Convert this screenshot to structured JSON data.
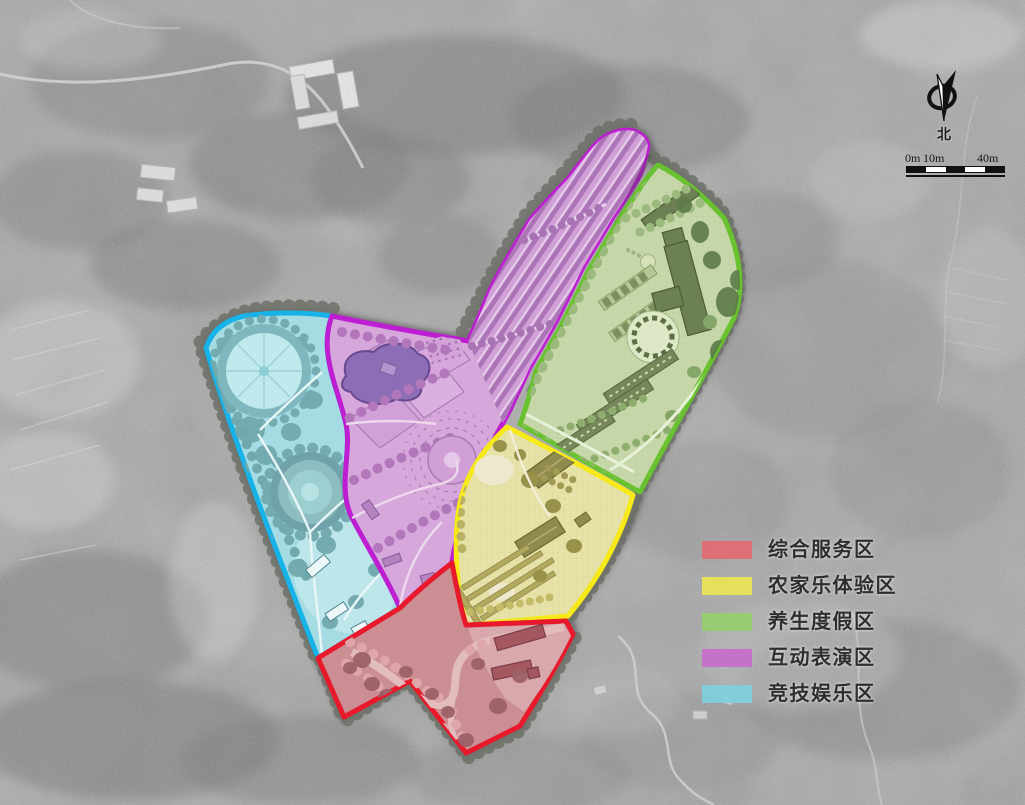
{
  "legend": {
    "items": [
      {
        "key": "comprehensive-service",
        "label": "综合服务区",
        "color": "#e26b72"
      },
      {
        "key": "farmhouse-experience",
        "label": "农家乐体验区",
        "color": "#ece455"
      },
      {
        "key": "health-resort",
        "label": "养生度假区",
        "color": "#94cf6d"
      },
      {
        "key": "interactive-performance",
        "label": "互动表演区",
        "color": "#c56ecb"
      },
      {
        "key": "competitive-entertainment",
        "label": "竞技娱乐区",
        "color": "#7fcfdf"
      }
    ]
  },
  "zones": [
    {
      "key": "comprehensive-service",
      "name": "综合服务区",
      "fill": "#cb8e93",
      "outline": "#e8192b"
    },
    {
      "key": "farmhouse-experience",
      "name": "农家乐体验区",
      "fill": "#e6e2a8",
      "outline": "#f8ea16"
    },
    {
      "key": "health-resort",
      "name": "养生度假区",
      "fill": "#c6d7a9",
      "outline": "#67c22e"
    },
    {
      "key": "interactive-performance",
      "name": "互动表演区",
      "fill": "#d6a7db",
      "outline": "#bd1ed1"
    },
    {
      "key": "competitive-entertainment",
      "name": "竞技娱乐区",
      "fill": "#a5dce3",
      "outline": "#16b2e8"
    }
  ],
  "compass": {
    "north_label": "北"
  },
  "scale_bar": {
    "labels": [
      "0m",
      "10m",
      "40m"
    ]
  }
}
